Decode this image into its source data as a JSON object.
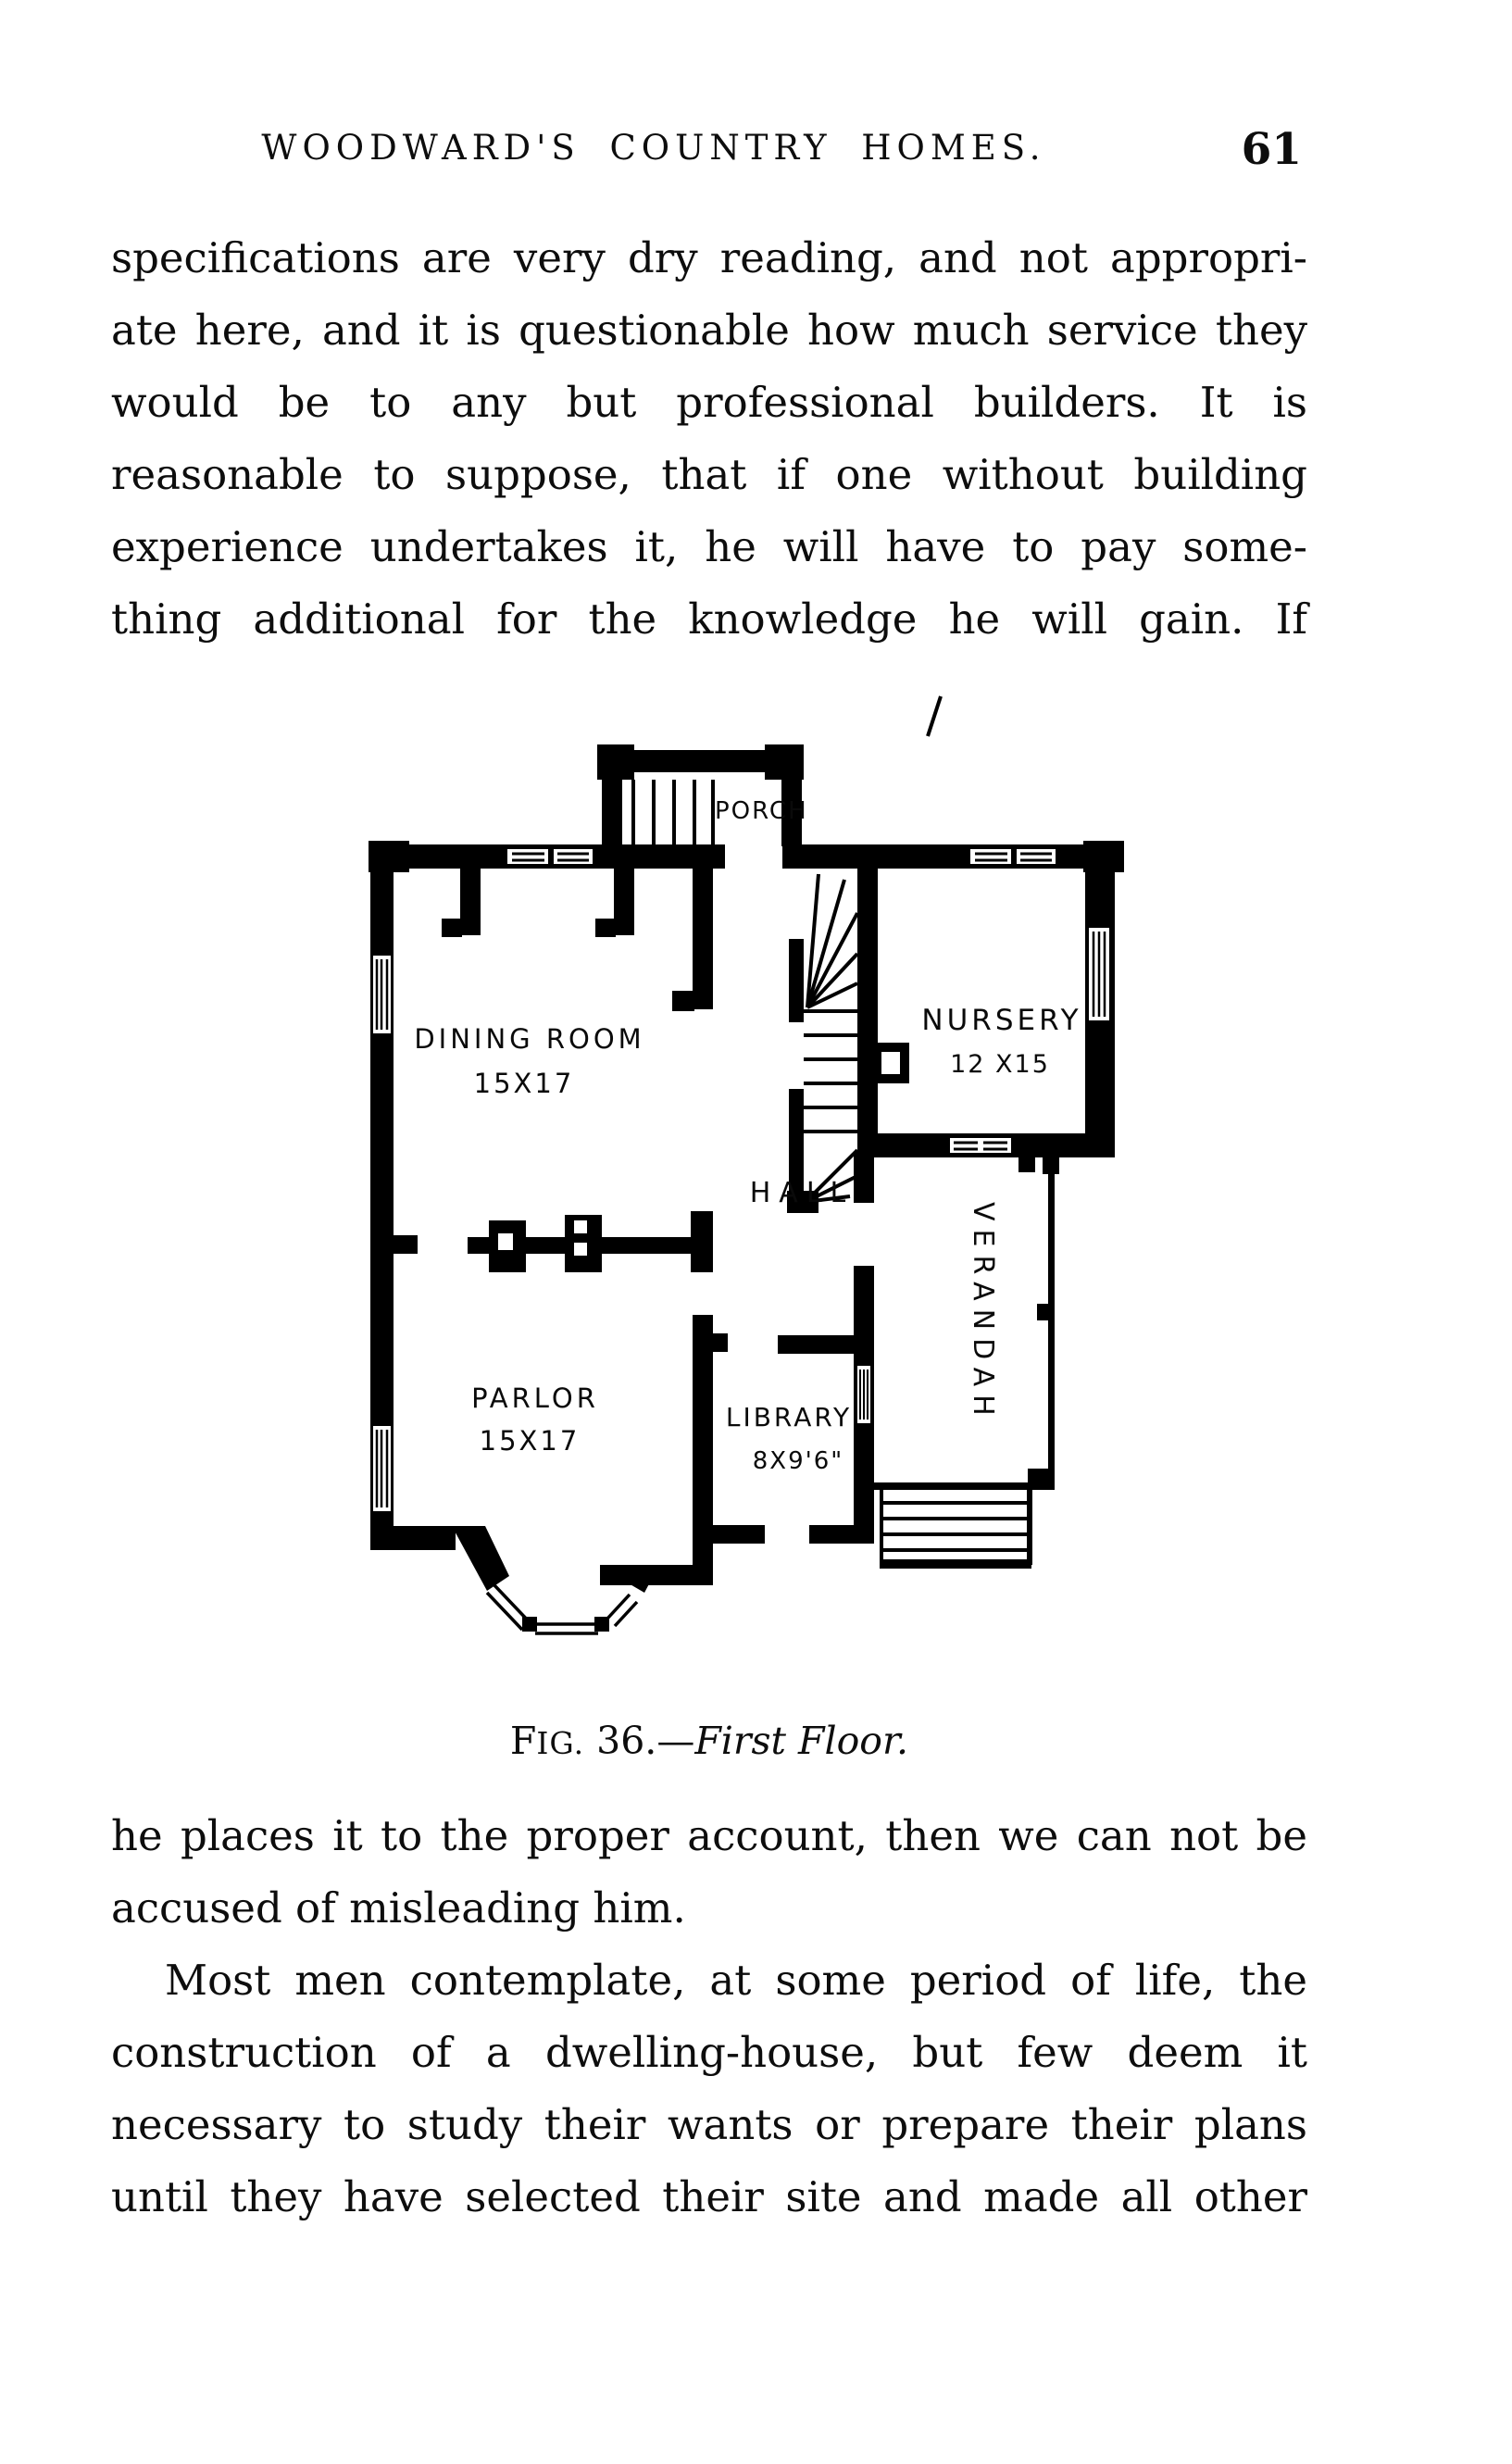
{
  "header": {
    "title": "WOODWARD'S COUNTRY HOMES.",
    "page_number": "61"
  },
  "paragraphs": [
    {
      "lines": [
        "specifications are very dry reading, and not appropri-",
        "ate here, and it is questionable how much service they",
        "would be to any but professional builders.  It is",
        "reasonable to suppose, that if one without building",
        "experience undertakes it, he will have to pay some-",
        "thing additional for the knowledge he will gain.  If"
      ]
    },
    {
      "lines": [
        "he places it to the proper account, then we can not be",
        "accused of misleading him."
      ]
    },
    {
      "lines": [
        "Most men contemplate, at some period of life, the",
        "construction of a dwelling-house, but few deem it",
        "necessary to study their wants or prepare their plans",
        "until they have selected their site and made all other"
      ]
    }
  ],
  "figure": {
    "caption": {
      "fig_f": "F",
      "fig_rest": "IG.",
      "number": " 36.—",
      "title": "First Floor."
    },
    "rooms": {
      "porch": {
        "label": "PORCH"
      },
      "dining": {
        "label": "DINING ROOM",
        "size": "15X17"
      },
      "nursery": {
        "label": "NURSERY",
        "size": "12 X15"
      },
      "hall": {
        "label": "HALL"
      },
      "verandah": {
        "label": "VERANDAH"
      },
      "parlor": {
        "label": "PARLOR",
        "size": "15X17"
      },
      "library": {
        "label": "LIBRARY",
        "size": "8X9'6\""
      }
    },
    "ink_color": "#000000",
    "paper_color": "#ffffff"
  }
}
